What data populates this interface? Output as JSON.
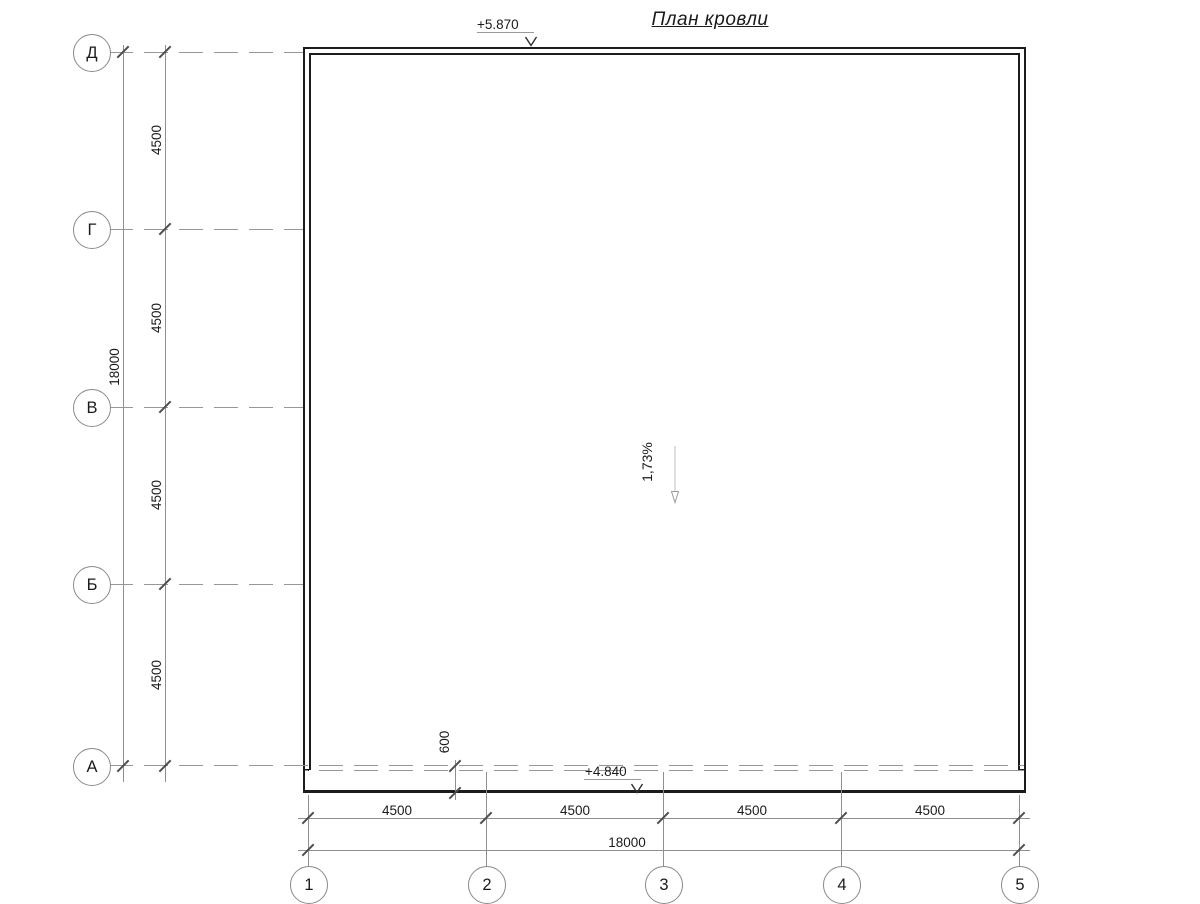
{
  "title": "План кровли",
  "annotations": {
    "elevation_top": "+5.870",
    "elevation_bottom": "+4.840",
    "slope": "1,73%",
    "overhang": "600"
  },
  "axes": {
    "rows": [
      "Д",
      "Г",
      "В",
      "Б",
      "А"
    ],
    "cols": [
      "1",
      "2",
      "3",
      "4",
      "5"
    ]
  },
  "dimensions": {
    "left": {
      "segments": [
        "4500",
        "4500",
        "4500",
        "4500"
      ],
      "total": "18000"
    },
    "bottom": {
      "segments": [
        "4500",
        "4500",
        "4500",
        "4500"
      ],
      "total": "18000"
    }
  },
  "colors": {
    "background": "#ffffff",
    "outline": "#1c1c1c",
    "thin_line": "#8f8f8f",
    "dashed_line": "#979797",
    "tick": "#4d4d4d",
    "text": "#1b1b1b"
  }
}
